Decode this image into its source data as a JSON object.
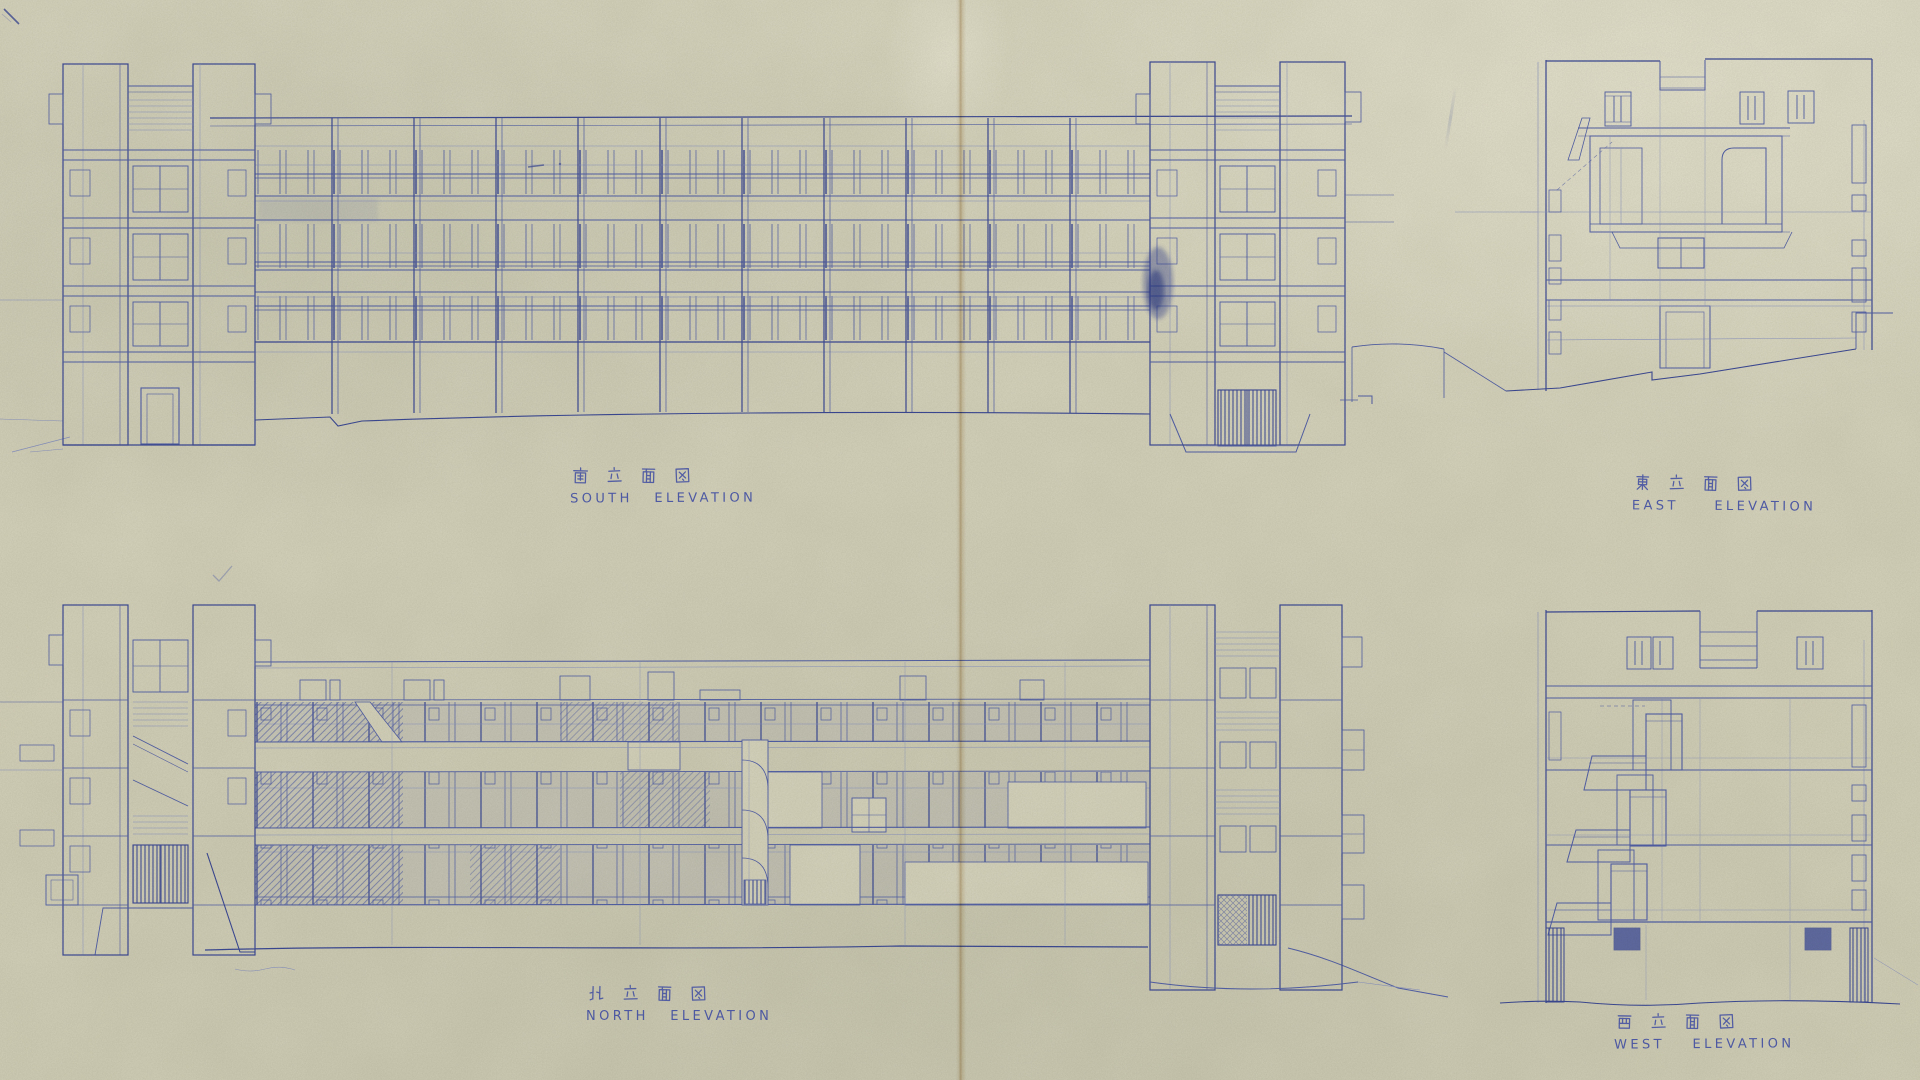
{
  "palette": {
    "paper": "#d7d4be",
    "ink": "#5260a8",
    "ink_strong": "#3c4a96",
    "ink_faint": "#8a94c2",
    "pencil": "#8d95b5",
    "crease_tan": "#a67a3a",
    "label_blue": "#4350a2"
  },
  "sections": [
    {
      "id": "south",
      "kanji": "南立面図",
      "english": "SOUTH ELEVATION"
    },
    {
      "id": "east",
      "kanji": "東立面図",
      "english": "EAST  ELEVATION"
    },
    {
      "id": "north",
      "kanji": "北立面図",
      "english": "NORTH  ELEVATION"
    },
    {
      "id": "west",
      "kanji": "西立面図",
      "english": "WEST  ELEVATION"
    }
  ]
}
